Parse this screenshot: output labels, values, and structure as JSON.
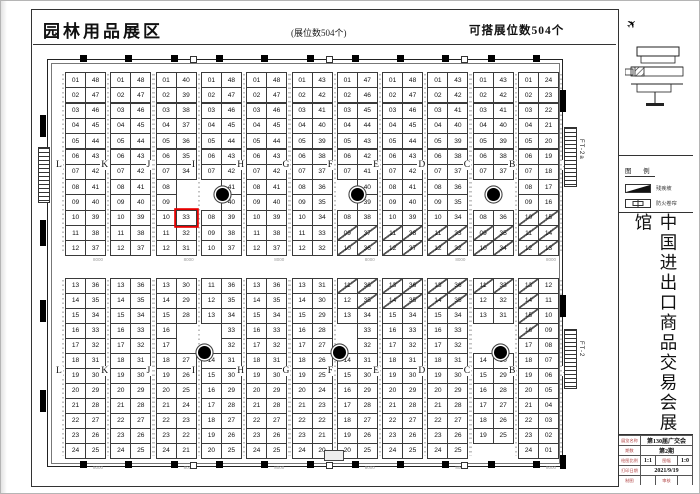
{
  "header": {
    "title": "园林用品展区",
    "booth_note": "(展位数504个)",
    "buildable_note": "可搭展位数504个"
  },
  "hall": {
    "aisle_letters": [
      "L",
      "K",
      "J",
      "I",
      "H",
      "G",
      "F",
      "E",
      "D",
      "C",
      "B",
      "A"
    ],
    "stair_top_label": "FT-2a",
    "stair_bottom_label": "FT-2",
    "dimension_label": "8000",
    "selected_booth": "33",
    "top_blocks": [
      {
        "left": [
          "01",
          "02",
          "03",
          "04",
          "05",
          "06",
          "07",
          "08",
          "09",
          "10",
          "11",
          "12"
        ],
        "right": [
          "48",
          "47",
          "46",
          "45",
          "44",
          "43",
          "42",
          "41",
          "40",
          "39",
          "38",
          "37"
        ]
      },
      {
        "left": [
          "01",
          "02",
          "03",
          "04",
          "05",
          "06",
          "07",
          "08",
          "09",
          "10",
          "11",
          "12"
        ],
        "right": [
          "48",
          "47",
          "46",
          "45",
          "44",
          "43",
          "42",
          "41",
          "40",
          "39",
          "38",
          "37"
        ]
      },
      {
        "left": [
          "01",
          "02",
          "03",
          "04",
          "05",
          "06",
          "07",
          "08",
          "09",
          "10",
          "11",
          "12"
        ],
        "right": [
          "40",
          "39",
          "38",
          "37",
          "36",
          "35",
          "34",
          null,
          null,
          "33|r",
          "32",
          "31"
        ]
      },
      {
        "left": [
          "01",
          "02",
          "03",
          "04",
          "05",
          "06",
          "07",
          null,
          null,
          "08",
          "09",
          "10"
        ],
        "right": [
          "48",
          "47",
          "46",
          "45",
          "44",
          "43",
          "42",
          "41",
          "40",
          "39",
          "38",
          "37"
        ]
      },
      {
        "left": [
          "01",
          "02",
          "03",
          "04",
          "05",
          "06",
          "07",
          "08",
          "09",
          "10",
          "11",
          "12"
        ],
        "right": [
          "48",
          "47",
          "46",
          "45",
          "44",
          "43",
          "42",
          "41",
          "40",
          "39",
          "38",
          "37"
        ]
      },
      {
        "left": [
          "01",
          "02",
          "03",
          "04",
          "05",
          "06",
          "07",
          "08",
          "09",
          "10",
          "11",
          "12"
        ],
        "right": [
          "43",
          "42",
          "41",
          "40",
          "39",
          "38",
          "37",
          "36",
          "35",
          "34",
          "33",
          "32"
        ]
      },
      {
        "left": [
          "01",
          "02",
          "03",
          "04",
          "05",
          "06",
          "07",
          null,
          null,
          "08",
          "09|d",
          "10|d"
        ],
        "right": [
          "47",
          "46",
          "45",
          "44",
          "43",
          "42",
          "41",
          "40",
          "39",
          "38",
          "37|d",
          "36|d"
        ]
      },
      {
        "left": [
          "01",
          "02",
          "03",
          "04",
          "05",
          "06",
          "07",
          "08",
          "09",
          "10",
          "11|d",
          "12|d"
        ],
        "right": [
          "48",
          "47",
          "46",
          "45",
          "44",
          "43",
          "42",
          "41",
          "40",
          "39",
          "38|d",
          "37|d"
        ]
      },
      {
        "left": [
          "01",
          "02",
          "03",
          "04",
          "05",
          "06",
          "07",
          "08",
          "09",
          "10",
          "11|d",
          "12|d"
        ],
        "right": [
          "43",
          "42",
          "41",
          "40",
          "39",
          "38",
          "37",
          "36",
          "35",
          "34",
          "33|d",
          "32|d"
        ]
      },
      {
        "left": [
          "01",
          "02",
          "03",
          "04",
          "05",
          "06",
          "07",
          null,
          null,
          "08",
          "09|d",
          "10|d"
        ],
        "right": [
          "43",
          "42",
          "41",
          "40",
          "39",
          "38",
          "37",
          null,
          null,
          "36",
          "35|d",
          "34|d"
        ]
      },
      {
        "left": [
          "01",
          "02",
          "03",
          "04",
          "05",
          "06",
          "07",
          "08",
          "09",
          "10|d",
          "11|d",
          "12|d"
        ],
        "right": [
          "24",
          "23",
          "22",
          "21",
          "20",
          "19",
          "18",
          "17",
          "16",
          "15|d",
          "14|d",
          "13|d"
        ]
      }
    ],
    "bottom_blocks": [
      {
        "left": [
          "13",
          "14",
          "15",
          "16",
          "17",
          "18",
          "19",
          "20",
          "21",
          "22",
          "23",
          "24"
        ],
        "right": [
          "36",
          "35",
          "34",
          "33",
          "32",
          "31",
          "30",
          "29",
          "28",
          "27",
          "26",
          "25"
        ]
      },
      {
        "left": [
          "13",
          "14",
          "15",
          "16",
          "17",
          "18",
          "19",
          "20",
          "21",
          "22",
          "23",
          "24"
        ],
        "right": [
          "36",
          "35",
          "34",
          "33",
          "32",
          "31",
          "30",
          "29",
          "28",
          "27",
          "26",
          "25"
        ]
      },
      {
        "left": [
          "13",
          "14",
          "15",
          "16",
          "17",
          "18",
          "19",
          "20",
          "21",
          "22",
          "23",
          "24"
        ],
        "right": [
          "30",
          "29",
          "28",
          null,
          null,
          "27",
          "26",
          "25",
          "24",
          "23",
          "22",
          "21"
        ]
      },
      {
        "left": [
          "11",
          "12",
          "13",
          null,
          null,
          "14",
          "15",
          "16",
          "17",
          "18",
          "19",
          "20"
        ],
        "right": [
          "36",
          "35",
          "34",
          "33",
          "32",
          "31",
          "30",
          "29",
          "28",
          "27",
          "26",
          "25"
        ]
      },
      {
        "left": [
          "13",
          "14",
          "15",
          "16",
          "17",
          "18",
          "19",
          "20",
          "21",
          "22",
          "23",
          "24"
        ],
        "right": [
          "36",
          "35",
          "34",
          "33",
          "32",
          "31",
          "30",
          "29",
          "28",
          "27",
          "26",
          "25"
        ]
      },
      {
        "left": [
          "13",
          "14",
          "15",
          "16",
          "17",
          "18",
          "19",
          "20",
          "21",
          "22",
          "23",
          "24"
        ],
        "right": [
          "31",
          "30",
          "29",
          "28",
          "27",
          "26",
          "25",
          "24",
          "23",
          "22",
          "21",
          "20"
        ]
      },
      {
        "left": [
          "11|d",
          "12",
          "13",
          null,
          null,
          "14",
          "15",
          "16",
          "17",
          "18",
          "19",
          "20"
        ],
        "right": [
          "36|d",
          "35|d",
          "34",
          "33",
          "32",
          "31",
          "30",
          "29",
          "28",
          "27",
          "26",
          "25"
        ]
      },
      {
        "left": [
          "13|d",
          "14|d",
          "15",
          "16",
          "17",
          "18",
          "19",
          "20",
          "21",
          "22",
          "23",
          "24"
        ],
        "right": [
          "36|d",
          "35|d",
          "34",
          "33",
          "32",
          "31",
          "30",
          "29",
          "28",
          "27",
          "26",
          "25"
        ]
      },
      {
        "left": [
          "13|d",
          "14|d",
          "15",
          "16",
          "17",
          "18",
          "19",
          "20",
          "21",
          "22",
          "23",
          "24"
        ],
        "right": [
          "36|d",
          "35|d",
          "34",
          "33",
          "32",
          "31",
          "30",
          "29",
          "28",
          "27",
          "26",
          "25"
        ]
      },
      {
        "left": [
          "11|d",
          "12",
          "13",
          null,
          null,
          "14",
          "15",
          "16",
          "17",
          "18",
          "19",
          null
        ],
        "right": [
          "33|d",
          "32",
          "31",
          null,
          null,
          "30",
          "29",
          "28",
          "27",
          "26",
          "25",
          null
        ]
      },
      {
        "left": [
          "13|d",
          "14|d",
          "15|d",
          "16|d",
          "17",
          "18",
          "19",
          "20",
          "21",
          "22",
          "23",
          "24"
        ],
        "right": [
          "12",
          "11",
          "10",
          "09",
          "08",
          "07",
          "06",
          "05",
          "04",
          "03",
          "02",
          "01"
        ]
      }
    ]
  },
  "panel": {
    "legend_title": "图 例",
    "legend_items": [
      {
        "icon": "ramp-icon",
        "label": "残疾坡"
      },
      {
        "icon": "fire-shutter-icon",
        "label": "防火卷帘"
      }
    ],
    "hall_name": "中国进出口商品交易会展馆",
    "titleblock_rows": [
      {
        "cells": [
          {
            "t": "展览名称",
            "k": "label"
          },
          {
            "t": "第130届广交会",
            "k": "val"
          }
        ]
      },
      {
        "cells": [
          {
            "t": "期数",
            "k": "label"
          },
          {
            "t": "第2期",
            "k": "val"
          }
        ]
      },
      {
        "cells": [
          {
            "t": "绘图比例",
            "k": "label"
          },
          {
            "t": "1:1",
            "k": "val small"
          },
          {
            "t": "图幅",
            "k": "label"
          },
          {
            "t": "1:0",
            "k": "val small"
          }
        ]
      },
      {
        "cells": [
          {
            "t": "打印日期",
            "k": "label"
          },
          {
            "t": "2021/9/19",
            "k": "val small"
          }
        ]
      },
      {
        "cells": [
          {
            "t": "制图",
            "k": "label"
          },
          {
            "t": "",
            "k": "val small"
          },
          {
            "t": "审核",
            "k": "label"
          },
          {
            "t": "",
            "k": "val small"
          }
        ]
      }
    ]
  }
}
